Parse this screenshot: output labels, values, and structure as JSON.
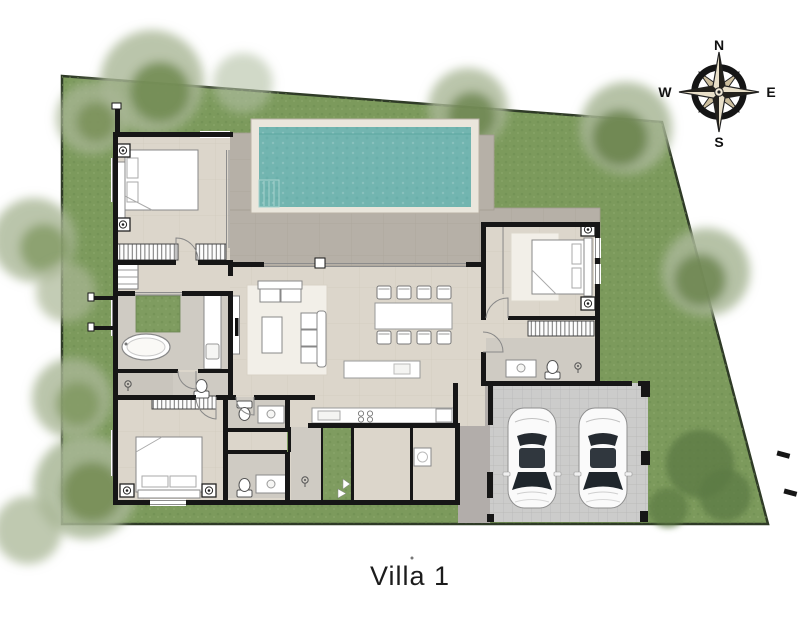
{
  "title": {
    "label": "Villa 1"
  },
  "compass": {
    "north": "N",
    "east": "E",
    "south": "S",
    "west": "W"
  },
  "colors": {
    "background": "#ffffff",
    "lawn": "#7c9a5c",
    "lawn_border": "#2e3a26",
    "pool_water": "#72b5b0",
    "pool_coping": "#eae6dc",
    "deck": "#b6b0a7",
    "floor": "#dcd6cb",
    "bath_floor": "#cfcbc3",
    "wall": "#161616",
    "garage_tile": "#cccccb",
    "walkway": "#b2adaa",
    "furniture": "#ffffff",
    "courtyard": "#7f9c60",
    "title_color": "#1c1c1c"
  }
}
